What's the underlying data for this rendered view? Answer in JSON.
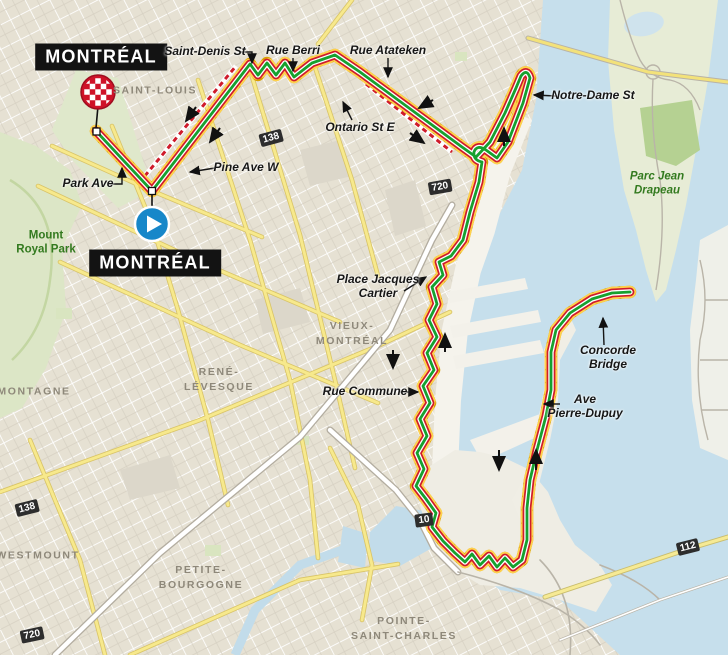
{
  "map": {
    "city_labels": [
      {
        "id": "finish-city",
        "text": "MONTRÉAL",
        "x": 101,
        "y": 57
      },
      {
        "id": "start-city",
        "text": "MONTRÉAL",
        "x": 155,
        "y": 263
      }
    ],
    "neighborhoods": [
      {
        "lines": [
          "SAINT-LOUIS"
        ],
        "x": 155,
        "y": 91
      },
      {
        "lines": [
          "VIEUX-",
          "MONTRÉAL"
        ],
        "x": 352,
        "y": 334
      },
      {
        "lines": [
          "RENÉ-",
          "LÉVESQUE"
        ],
        "x": 219,
        "y": 380
      },
      {
        "lines": [
          "MONTAGNE"
        ],
        "x": 34,
        "y": 392
      },
      {
        "lines": [
          "WESTMOUNT"
        ],
        "x": 38,
        "y": 556
      },
      {
        "lines": [
          "PETITE-",
          "BOURGOGNE"
        ],
        "x": 201,
        "y": 578
      },
      {
        "lines": [
          "POINTE-",
          "SAINT-CHARLES"
        ],
        "x": 404,
        "y": 629
      }
    ],
    "streets": [
      {
        "lines": [
          "Saint-Denis St"
        ],
        "x": 205,
        "y": 52
      },
      {
        "lines": [
          "Rue Berri"
        ],
        "x": 293,
        "y": 51
      },
      {
        "lines": [
          "Rue Atateken"
        ],
        "x": 388,
        "y": 51
      },
      {
        "lines": [
          "Notre-Dame St"
        ],
        "x": 593,
        "y": 96
      },
      {
        "lines": [
          "Ontario St E"
        ],
        "x": 360,
        "y": 128
      },
      {
        "lines": [
          "Pine Ave W"
        ],
        "x": 246,
        "y": 168
      },
      {
        "lines": [
          "Park Ave"
        ],
        "x": 88,
        "y": 184
      },
      {
        "lines": [
          "Place Jacques",
          "Cartier"
        ],
        "x": 378,
        "y": 287
      },
      {
        "lines": [
          "Rue Commune"
        ],
        "x": 365,
        "y": 392
      },
      {
        "lines": [
          "Concorde",
          "Bridge"
        ],
        "x": 608,
        "y": 358
      },
      {
        "lines": [
          "Ave",
          "Pierre-Dupuy"
        ],
        "x": 585,
        "y": 407
      }
    ],
    "parks": [
      {
        "lines": [
          "Mount",
          "Royal Park"
        ],
        "x": 46,
        "y": 243,
        "italic": false
      },
      {
        "lines": [
          "Parc Jean",
          "Drapeau"
        ],
        "x": 657,
        "y": 184,
        "italic": true
      }
    ],
    "shields": [
      {
        "num": "138",
        "x": 271,
        "y": 138,
        "rot": -15
      },
      {
        "num": "720",
        "x": 440,
        "y": 187,
        "rot": -10
      },
      {
        "num": "138",
        "x": 27,
        "y": 508,
        "rot": -14
      },
      {
        "num": "720",
        "x": 32,
        "y": 635,
        "rot": -12
      },
      {
        "num": "10",
        "x": 424,
        "y": 520,
        "rot": -8
      },
      {
        "num": "112",
        "x": 688,
        "y": 547,
        "rot": -14
      }
    ],
    "icons": {
      "start": "play-icon",
      "finish": "checkered-finish-icon"
    },
    "colors": {
      "water": "#c6dfec",
      "land": "#e6e1d3",
      "park": "#dce6c6",
      "island": "#e7ecd6",
      "forest": "#b5d192",
      "route_gold_dark": "#d99f00",
      "route_gold": "#ffd24d",
      "route_red": "#cf1b2b",
      "route_white": "#ffffff",
      "route_green": "#17a12e",
      "start_blue": "#1787c9",
      "finish_red": "#cf1228",
      "road_yellow": "#f7e98c"
    }
  }
}
